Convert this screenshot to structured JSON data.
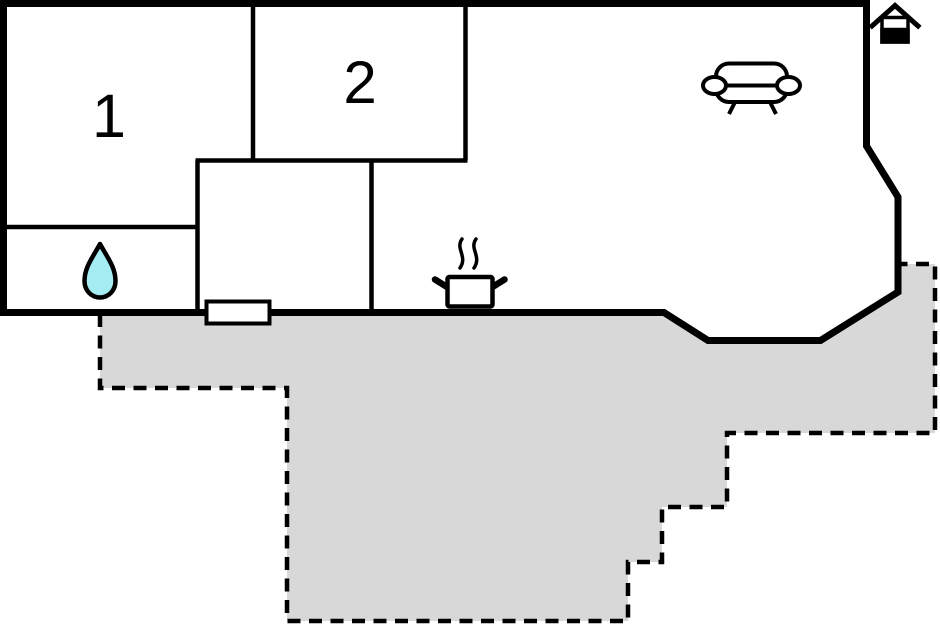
{
  "floorplan": {
    "type": "apartment-floor-plan",
    "rooms": [
      {
        "id": "room-1",
        "label": "1"
      },
      {
        "id": "room-2",
        "label": "2"
      }
    ],
    "icons": [
      {
        "name": "water-drop-icon",
        "area": "bathroom"
      },
      {
        "name": "cooking-pot-icon",
        "area": "kitchen"
      },
      {
        "name": "sofa-icon",
        "area": "living-room"
      },
      {
        "name": "entrance-house-icon",
        "area": "entrance"
      }
    ],
    "colors": {
      "walls": "#000000",
      "background": "#FFFFFF",
      "terrace": "#D8D8D8",
      "water_drop": "#A5EDF2",
      "door": "#FFFFFF"
    }
  }
}
